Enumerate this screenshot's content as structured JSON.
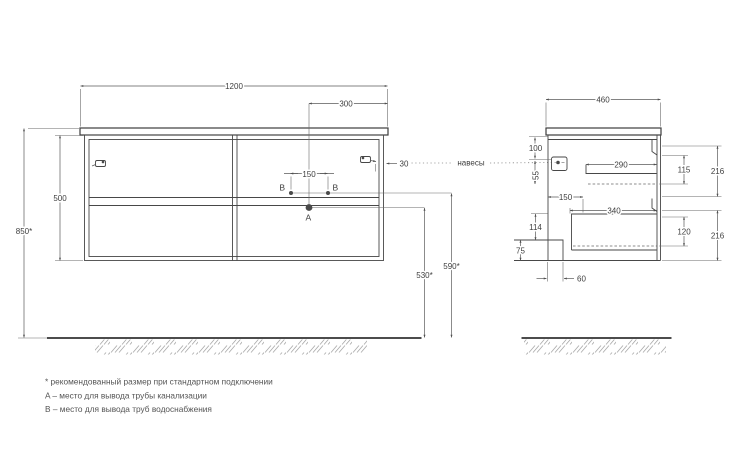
{
  "front_view": {
    "width": "1200",
    "center_to_edge": "300",
    "b_spacing": "150",
    "cabinet_height": "500",
    "total_height": "850*",
    "a_floor_height": "530*",
    "b_floor_height": "590*",
    "hanger_inset": "30",
    "label_a": "A",
    "label_b": "B"
  },
  "side_view": {
    "depth": "460",
    "hanger_top_offset": "100",
    "hanger_drop": "55",
    "front_offset": "150",
    "upper_drawer_width": "290",
    "upper_drawer_inner_height": "115",
    "upper_section_height": "216",
    "lower_drawer_width": "340",
    "lower_drawer_inner_height": "120",
    "lower_section_height": "216",
    "bottom_gap": "114",
    "plinth_height": "75",
    "recess_width": "60"
  },
  "callouts": {
    "hangers": "навесы"
  },
  "notes": [
    "* рекомендованный размер при стандартном подключении",
    "A – место для вывода трубы канализации",
    "B – место для вывода труб водоснабжения"
  ]
}
